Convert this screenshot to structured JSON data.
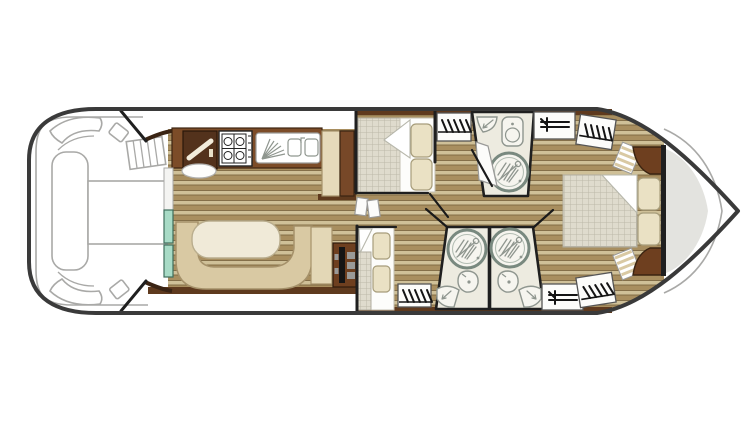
{
  "document": {
    "kind": "boat-floor-plan",
    "description": "Top-down deck plan of a canal cruiser with bow terrace, salon, galley, three cabins and three shower rooms",
    "visible_text": []
  },
  "palette": {
    "hull_stroke": "#3a3a3a",
    "outline_gray": "#a9a9a7",
    "deck_shadow": "#e3e3df",
    "wood_light": "#cfc098",
    "wood_dark": "#a88e5f",
    "wood_line": "#7c6640",
    "wall_dark": "#1f1f1f",
    "brown_band": "#5f3a1e",
    "brown_counter": "#7c4c28",
    "brown_column": "#774828",
    "brown_dark": "#53321c",
    "brown_corner": "#6e3f1f",
    "cabinet_beige": "#e6dabb",
    "bench_tan": "#d9c9a3",
    "bench_stroke": "#a5916a",
    "table_cream": "#f0ead8",
    "teal_glass": "#a8dbc6",
    "teal_stroke": "#3f6e5d",
    "checker_fill": "#dfdbcd",
    "checker_line": "#bcb8a9",
    "mattress_white": "#fdfdfb",
    "pillow_fill": "#eae1c4",
    "pillow_stroke": "#a79d7b",
    "bath_fill": "#edebe0",
    "fixture_fill": "#f6f5ef",
    "fixture_stroke": "#8f968f",
    "shower_ring": "#79897f",
    "icon_black": "#141414",
    "door_fill": "#fcfcfa",
    "door_stroke": "#9a9a98",
    "dots_bg": "#e3d7b6"
  },
  "areas": {
    "bow_deck": {
      "label": "Bow deck with lounger, table and steps"
    },
    "salon": {
      "label": "Salon with U-shaped bench and oval table"
    },
    "galley": {
      "label": "Galley with hob, double sink and tall cabinets"
    },
    "helm": {
      "label": "Inside helm station with steering wheel"
    },
    "cabin_front_top": {
      "label": "Forward cabin, double bed with two pillows"
    },
    "cabin_front_bottom": {
      "label": "Second cabin, bed with two pillows and wardrobe"
    },
    "bathroom_top": {
      "label": "Shower room with corner basin, toilet and round shower"
    },
    "bathroom_bottom_left": {
      "label": "Shower room with round shower, basin and corner toilet"
    },
    "bathroom_bottom_right": {
      "label": "Shower room with round shower, basin and corner toilet"
    },
    "aft_cabin": {
      "label": "Aft cabin, double bed with wardrobes and shelves"
    },
    "aft_deck": {
      "label": "Pointed aft deck"
    }
  },
  "fixtures": {
    "hanger_wardrobes": 4,
    "shelf_units": 2,
    "showers": 3,
    "basins": 4,
    "toilets": 3,
    "beds": 3,
    "hob_burners": 4,
    "sink_bowls": 2
  }
}
